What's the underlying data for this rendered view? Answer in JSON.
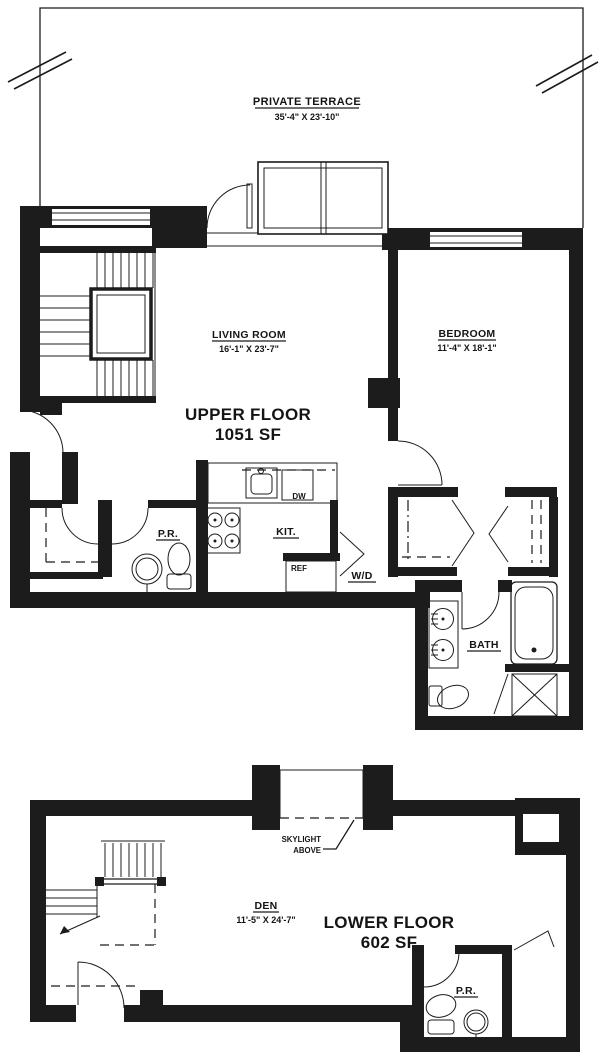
{
  "upper": {
    "terrace": {
      "label": "PRIVATE TERRACE",
      "dims": "35'-4\" X 23'-10\""
    },
    "living_room": {
      "label": "LIVING ROOM",
      "dims": "16'-1\" X 23'-7\""
    },
    "bedroom": {
      "label": "BEDROOM",
      "dims": "11'-4\" X 18'-1\""
    },
    "floor_title": "UPPER FLOOR",
    "floor_area": "1051 SF",
    "powder_room": "P.R.",
    "kitchen": "KIT.",
    "dishwasher": "DW",
    "refrigerator": "REF",
    "washer_dryer": "W/D",
    "bath": "BATH"
  },
  "lower": {
    "den": {
      "label": "DEN",
      "dims": "11'-5\" X 24'-7\""
    },
    "floor_title": "LOWER FLOOR",
    "floor_area": "602 SF",
    "skylight_note_line1": "SKYLIGHT",
    "skylight_note_line2": "ABOVE",
    "powder_room": "P.R."
  },
  "ink_color": "#1c1c1c",
  "paper_color": "#ffffff"
}
